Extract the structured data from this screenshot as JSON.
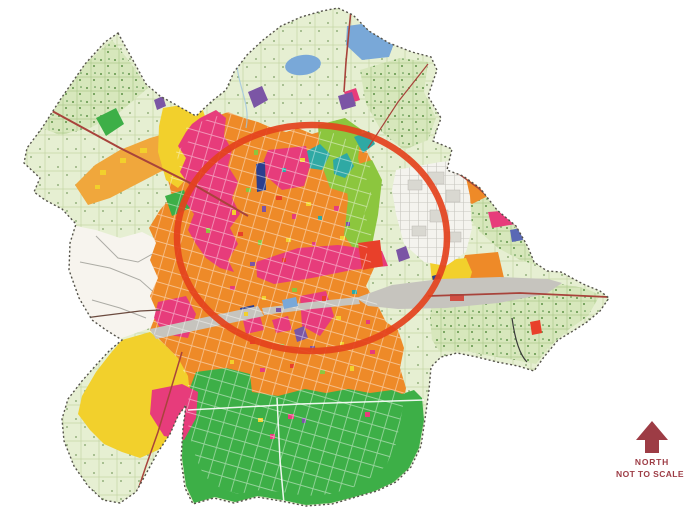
{
  "compass": {
    "label": "NORTH",
    "scale_note": "NOT TO SCALE",
    "color": "#9d3c45"
  },
  "highlight_circle": {
    "color": "#e4421d"
  },
  "palette": {
    "agricultural_light": "#e6efd2",
    "agricultural_dense": "#d7e7bc",
    "urban_orange": "#ee8a28",
    "corridor_orange": "#f0a73c",
    "gamtal_yellow": "#f2d02c",
    "pink_zone": "#e73c7b",
    "crimson_zone": "#e8402a",
    "green_zone": "#3daf47",
    "lime_zone": "#8cc63e",
    "teal_zone": "#2fa9a4",
    "purple_zone": "#7b55a5",
    "navy_zone": "#2b3f8e",
    "water_blue": "#79a8d8",
    "grey_band": "#c6c4be",
    "white_zone": "#f7f4ee",
    "road_red": "#a8433b",
    "boundary_dark": "#54524a"
  }
}
